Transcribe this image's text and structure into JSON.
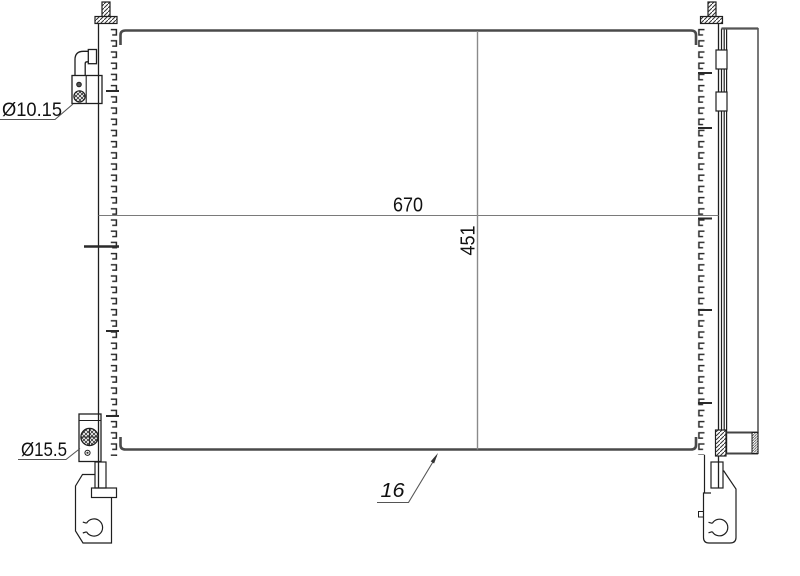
{
  "drawing": {
    "labels": {
      "core_width": "670",
      "core_height": "451",
      "core_depth": "16",
      "upper_port": "Ø10.15",
      "lower_port": "Ø15.5"
    },
    "colors": {
      "background": "#ffffff",
      "outline": "#1f1f1f",
      "core_edge": "#4a4a4a",
      "dimension_line": "#7a7a7a",
      "text": "#111111"
    }
  }
}
